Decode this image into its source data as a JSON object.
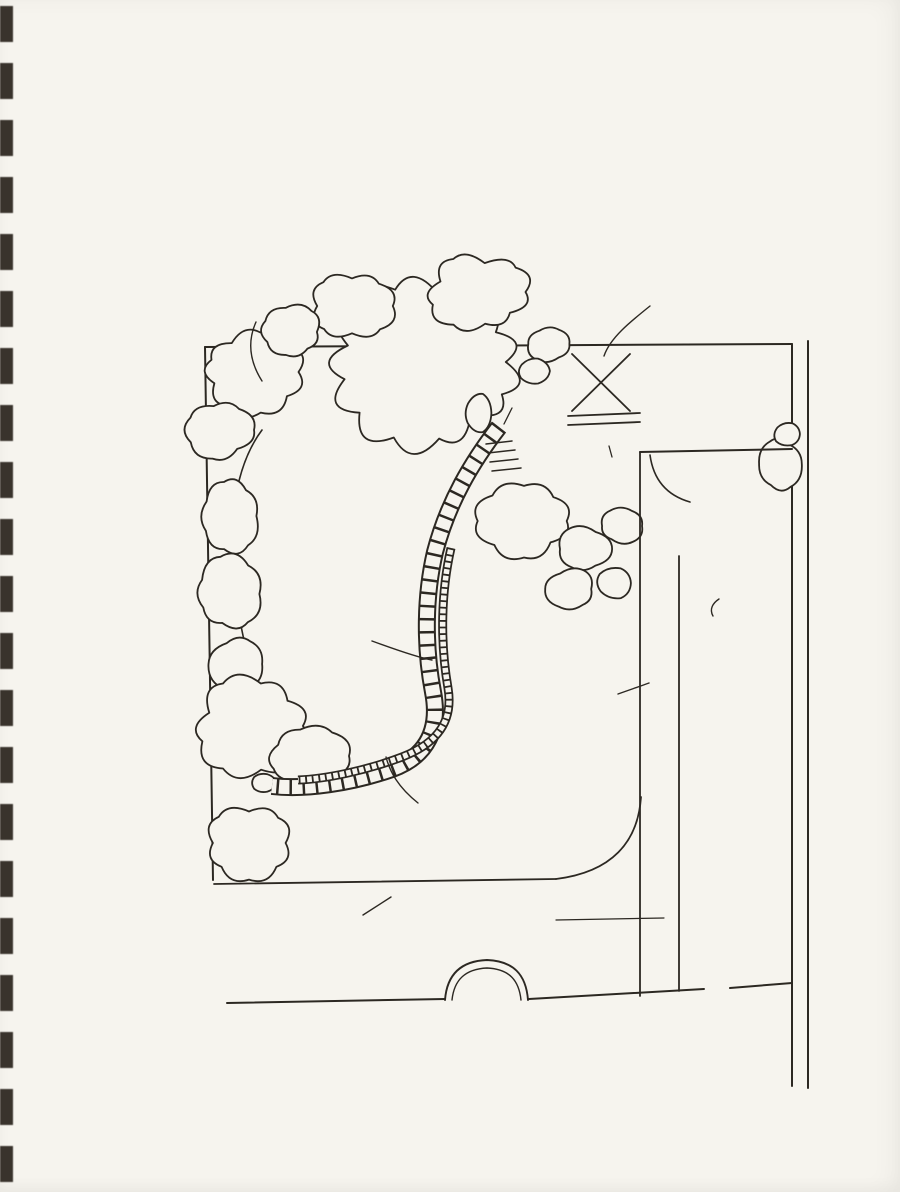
{
  "colors": {
    "ink": "#2c2822",
    "paper": "#f6f4ee"
  },
  "header": {
    "session": "SESSION 2003",
    "region": "France Métropolitaine",
    "program": "BTSA option AMENAGEMENTS PAYSAGERS"
  },
  "title": {
    "main": "DOCUMENT N°2",
    "subtitle": "(Esquisse)"
  },
  "compass": {
    "north": "N"
  },
  "scale_label": "Ech : 1/100",
  "footer": {
    "credit": "D' après \"TERRASSES ET PETITS JARDINS\" Grund",
    "level_note": "20,00 COTE PROJET (en m)"
  },
  "plan_labels": {
    "plantations1": "PLANTATIONS PLUS TOUFFUES",
    "plantations2": "POUR FAIRE ÉCRAN",
    "tas_de_compost": "TAS DE COMPOST",
    "cote_escalier": "20,00",
    "escalier": "ESCALIER",
    "ecran": "ÉCRAN",
    "cabane": "CABANE",
    "cote_cabane": "20,00",
    "aire1": "AIRE DE",
    "aire2": "TRAVAIL",
    "pelouse_sup": "PELOUSE SUPÉRIEURE",
    "cote_sup": "20,50",
    "pied1": "PIED DE MUR",
    "pied2": "DALLÉ",
    "remise1": "REMISE",
    "remise2": "DES",
    "remise3": "POUBELLES",
    "cote_allee": "20,10",
    "allee": "ALLÉE",
    "jardin1": "JARDIN DE",
    "jardin2": "PLANTES",
    "jardin3": "AROMATIQUES",
    "etde1": "ET DE",
    "etde2": "BOUQUETS",
    "pelouse_inf": "PELOUSE INFÉRIEURE",
    "muret1": "MURET BANQUETTE",
    "muret2": "DE SOUTENEMENT",
    "eau1": "EAU",
    "eau2": "+",
    "eau3": "ELECTRICITE",
    "pots1": "PLANTES",
    "pots2": "EN POTS",
    "terrasse": "TERRASSE",
    "cote_terrasse": "20,00",
    "regard": "REGARD"
  }
}
